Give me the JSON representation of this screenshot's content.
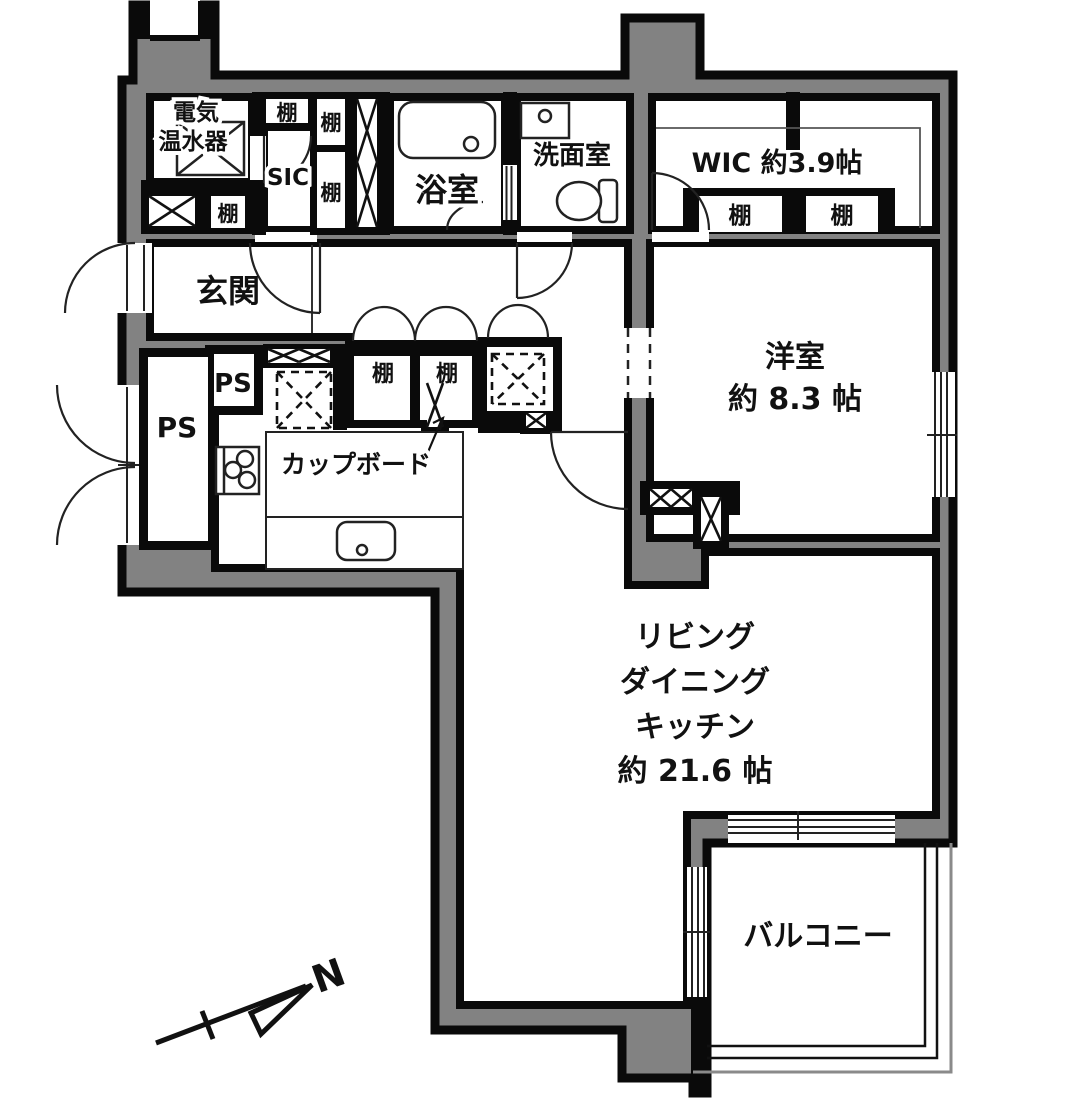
{
  "colors": {
    "wall_fill": "#828282",
    "line": "#0a0a0a",
    "bg": "#ffffff"
  },
  "labels": {
    "entrance": "玄関",
    "bath": "浴室",
    "washroom": "洗面室",
    "wic": "WIC 約3.9帖",
    "western_room_l1": "洋室",
    "western_room_l2": "約 8.3 帖",
    "ldk_l1": "リビング",
    "ldk_l2": "ダイニング",
    "ldk_l3": "キッチン",
    "ldk_l4": "約 21.6 帖",
    "balcony": "バルコニー",
    "sic": "SIC",
    "heater_l1": "電気",
    "heater_l2": "温水器",
    "cupboard": "カップボード",
    "north": "N",
    "ps": [
      "PS",
      "PS"
    ],
    "shelves": [
      "棚",
      "棚",
      "棚",
      "棚",
      "棚",
      "棚",
      "棚",
      "棚"
    ]
  }
}
